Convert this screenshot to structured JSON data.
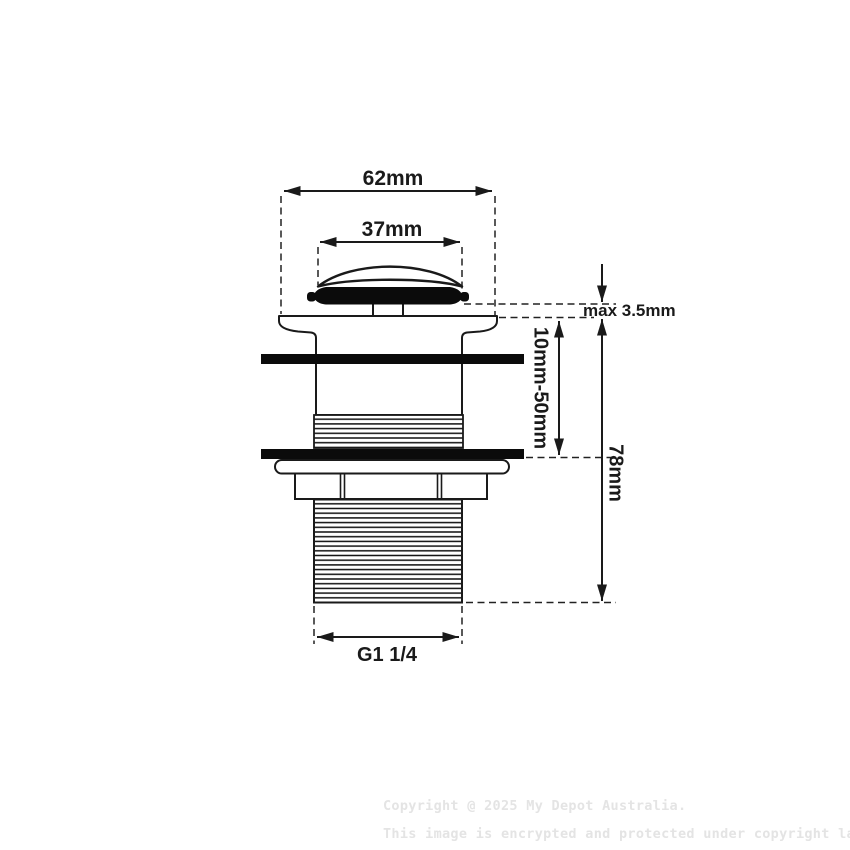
{
  "figure": {
    "background_color": "#ffffff",
    "line_color": "#1a1a1a"
  },
  "dimensions": {
    "flange_width": "62mm",
    "cap_width": "37mm",
    "max_gap": "max 3.5mm",
    "clamp_range": "10mm-50mm",
    "overall_height": "78mm",
    "thread_size": "G1 1/4"
  },
  "watermark": {
    "line1": "Copyright @ 2025 My Depot Australia.",
    "line2": "This image is encrypted and protected under copyright law.",
    "color": "#e4e4e4"
  }
}
